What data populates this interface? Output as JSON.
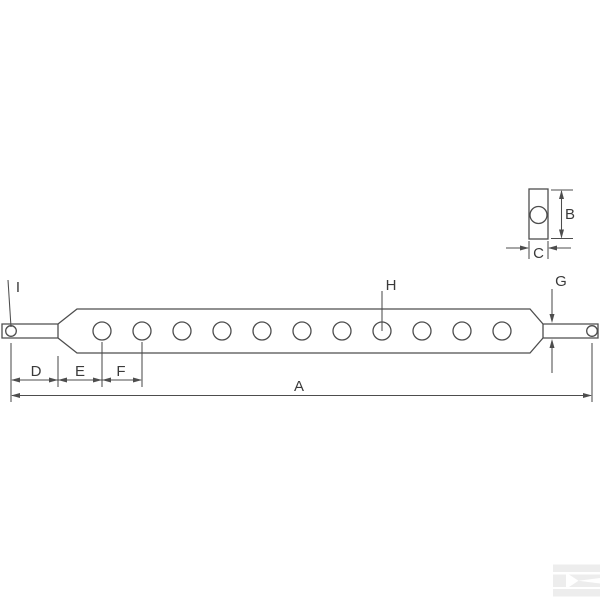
{
  "figure": {
    "type": "technical-dimension-drawing",
    "subject": "drawbar with end tabs and hole row",
    "colors": {
      "background": "#ffffff",
      "line": "#4d4d4d",
      "text": "#3a3a3a",
      "watermark": "#ededed"
    },
    "labels": {
      "dim_a": "A",
      "dim_b": "B",
      "dim_c": "C",
      "dim_d": "D",
      "dim_e": "E",
      "dim_f": "F",
      "dim_g": "G",
      "dim_h": "H",
      "dim_i": "I"
    },
    "bar": {
      "hole_count": 11,
      "hole_positions_x": [
        102,
        142,
        182,
        222,
        262,
        302,
        342,
        382,
        422,
        462,
        502
      ],
      "hole_center_y": 331,
      "hole_radius": 9,
      "end_hole_left_x": 11,
      "end_hole_right_x": 592,
      "end_hole_radius": 5.3
    },
    "side_view": {
      "plate_width_label": "C",
      "plate_height_label": "B",
      "hole_radius": 8.5
    },
    "watermark": {
      "icon": "kramp-k-logo"
    }
  }
}
